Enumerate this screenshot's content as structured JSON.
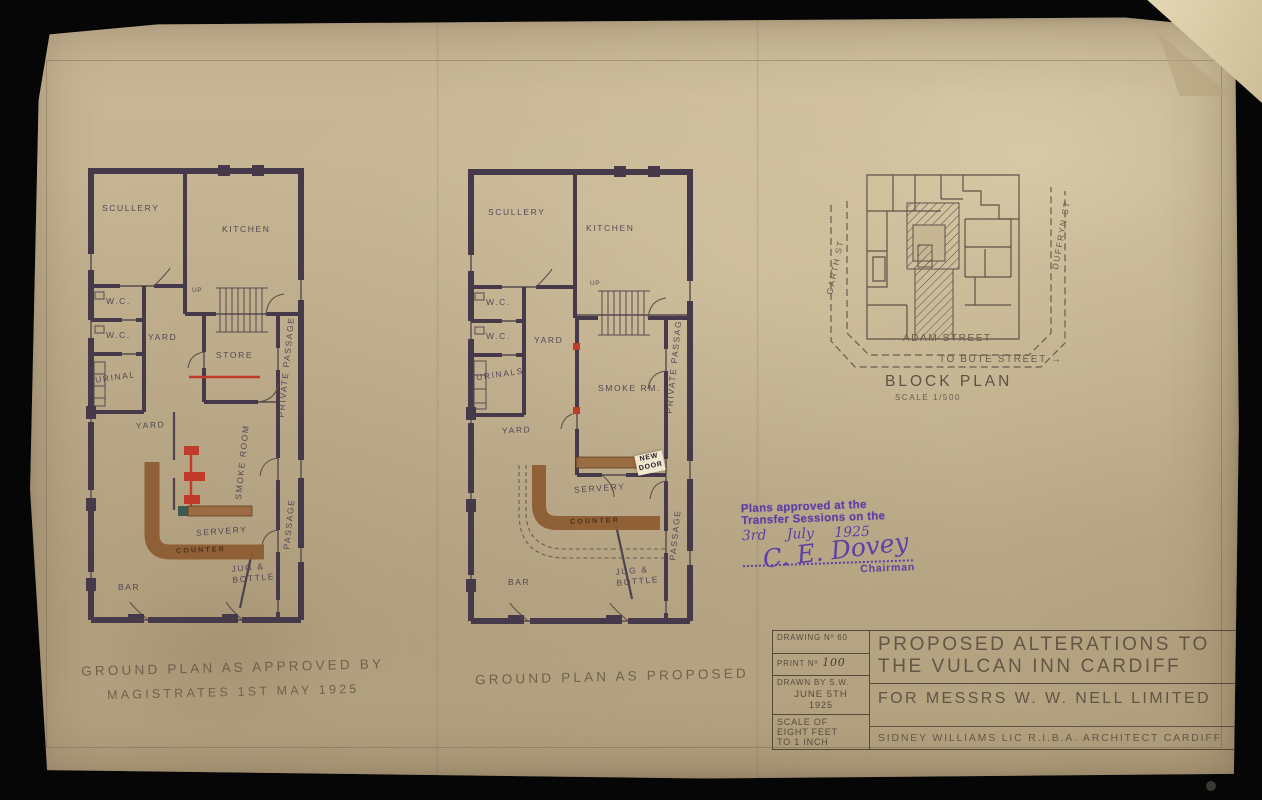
{
  "palette": {
    "paper": "#c8b795",
    "wall_ink": "#46394a",
    "pencil": "#6b5b4b",
    "alteration_red": "#c23b2a",
    "counter_brown": "#8d5c33",
    "stamp_purple": "#5d3fa6"
  },
  "approved_plan": {
    "caption_line1": "GROUND PLAN AS APPROVED BY",
    "caption_line2": "MAGISTRATES 1ST MAY 1925",
    "rooms": {
      "scullery": "SCULLERY",
      "kitchen": "KITCHEN",
      "up": "UP",
      "wc_upper": "W.C.",
      "wc_lower": "W.C.",
      "urinal": "URINAL",
      "yard_upper": "YARD",
      "store": "STORE",
      "yard_lower": "YARD",
      "smoke_room": "SMOKE ROOM",
      "servery": "SERVERY",
      "counter": "COUNTER",
      "bar": "BAR",
      "jug_line1": "JUG &",
      "jug_line2": "BOTTLE",
      "private_passage": "PRIVATE PASSAGE",
      "passage": "PASSAGE"
    }
  },
  "proposed_plan": {
    "caption": "GROUND PLAN AS PROPOSED",
    "rooms": {
      "scullery": "SCULLERY",
      "kitchen": "KITCHEN",
      "up": "UP",
      "wc_upper": "W.C.",
      "wc_lower": "W.C.",
      "urinals": "URINALS",
      "yard_upper": "YARD",
      "yard_lower": "YARD",
      "smoke_room": "SMOKE RM.",
      "new_door_line1": "NEW",
      "new_door_line2": "DOOR",
      "servery": "SERVERY",
      "counter": "COUNTER",
      "bar": "BAR",
      "jug_line1": "JUG &",
      "jug_line2": "BOTTLE",
      "private_passage": "PRIVATE PASSAGE",
      "passage": "PASSAGE"
    }
  },
  "block_plan": {
    "title": "BLOCK PLAN",
    "scale": "SCALE 1/500",
    "street_bottom": "ADAM STREET",
    "direction_note": "TO BUTE STREET →",
    "street_left": "GARTH ST",
    "street_right": "DUFFRYN ST"
  },
  "stamp": {
    "line1": "Plans approved at the",
    "line2": "Transfer Sessions on the",
    "date": "3rd July 1925",
    "signature": "C. E. Dovey",
    "role": "Chairman"
  },
  "title_block": {
    "drawing_no": "DRAWING Nº 60",
    "print_label": "PRINT Nº",
    "print_value": "100",
    "drawn_by": "DRAWN BY S.W.",
    "date_line1": "JUNE 5TH",
    "date_line2": "1925",
    "scale_line1": "SCALE OF",
    "scale_line2": "EIGHT FEET",
    "scale_line3": "TO 1 INCH",
    "title_line1": "PROPOSED ALTERATIONS TO",
    "title_line2": "THE VULCAN INN CARDIFF",
    "client_line": "FOR MESSRS W. W. NELL  LIMITED",
    "architect_line": "SIDNEY WILLIAMS   LIC R.I.B.A. ARCHITECT CARDIFF"
  }
}
